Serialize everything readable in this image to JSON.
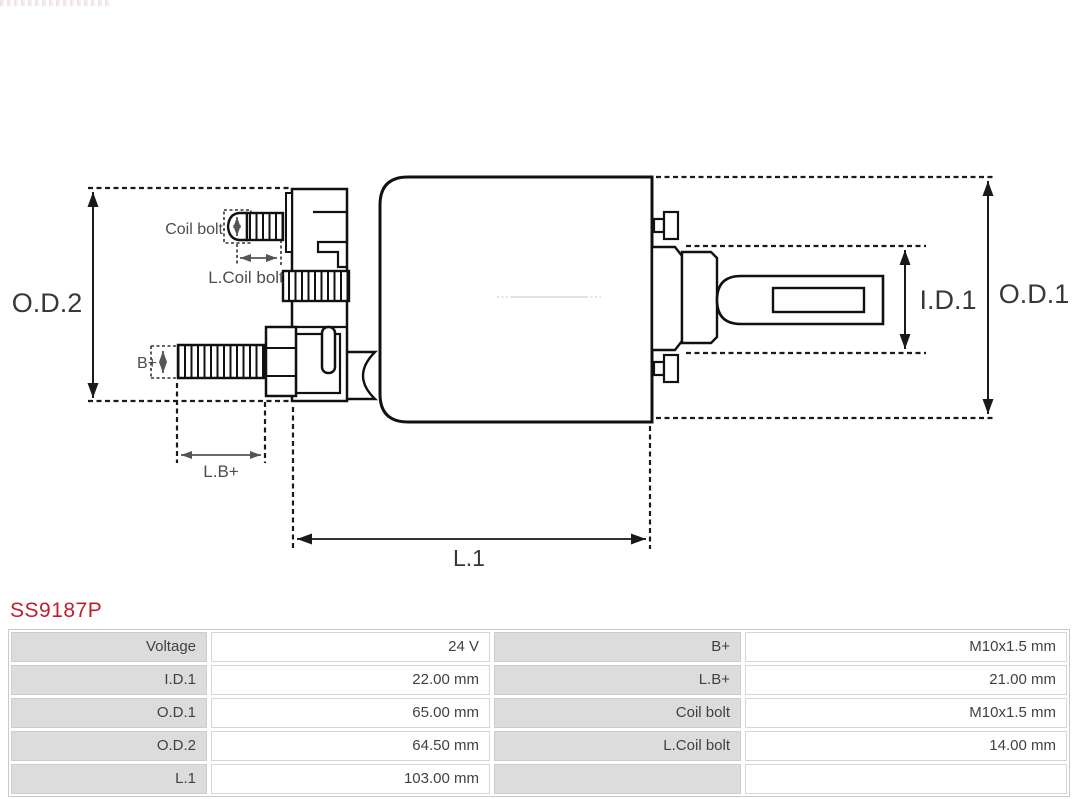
{
  "part_number": "SS9187P",
  "brand_color": "#be1f2e",
  "diagram": {
    "labels": {
      "od2": "O.D.2",
      "od1": "O.D.1",
      "id1": "I.D.1",
      "l1": "L.1",
      "coil_bolt": "Coil bolt",
      "l_coil_bolt": "L.Coil bolt",
      "b_plus": "B+",
      "l_b_plus": "L.B+"
    }
  },
  "spec_table": {
    "rows": [
      [
        "Voltage",
        "24 V",
        "B+",
        "M10x1.5 mm"
      ],
      [
        "I.D.1",
        "22.00 mm",
        "L.B+",
        "21.00 mm"
      ],
      [
        "O.D.1",
        "65.00 mm",
        "Coil bolt",
        "M10x1.5 mm"
      ],
      [
        "O.D.2",
        "64.50 mm",
        "L.Coil bolt",
        "14.00 mm"
      ],
      [
        "L.1",
        "103.00 mm",
        "",
        ""
      ]
    ]
  }
}
